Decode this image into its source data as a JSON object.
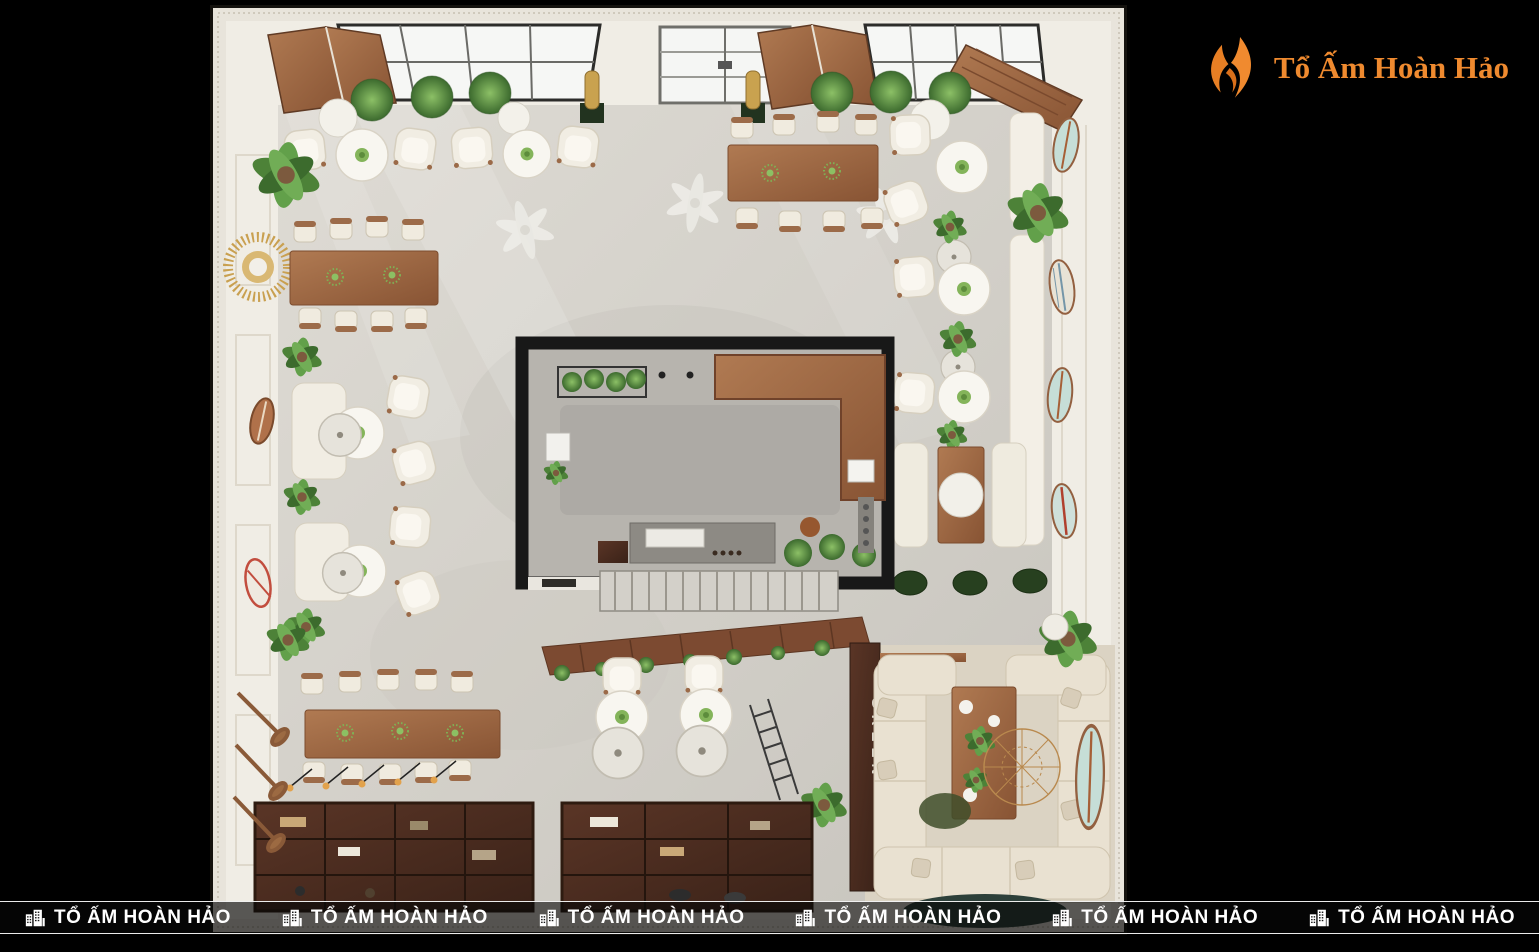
{
  "page": {
    "background": "#000000",
    "canvas_width": 1539,
    "canvas_height": 952
  },
  "logo": {
    "brand_text": "Tổ Ấm Hoàn Hảo",
    "icon": "flame-logo-icon",
    "text_color": "#ef8a2f"
  },
  "watermark": {
    "text": "TỔ ẤM HOÀN HẢO",
    "icon": "buildings-icon",
    "repeat_count": 6,
    "text_color": "#ffffff"
  },
  "render": {
    "type": "3d-interior-top-down-render",
    "subject": "cafe restaurant floor plan viewed from above",
    "partition_sign_text": "GREEN",
    "palette": {
      "wall": "#f0ede5",
      "molding": "#e8e4db",
      "floor": "#d6d3cc",
      "wood": "#a06d4a",
      "dark_wood": "#4e2f21",
      "upholstery": "#f1ede3",
      "plant_green": "#5e9447",
      "bar_frame": "#181818",
      "lounge_rug": "#dbd3c3",
      "accent_teal": "#c6ded7",
      "accent_gold": "#c9a050",
      "brand_orange": "#ef8a2f"
    }
  }
}
